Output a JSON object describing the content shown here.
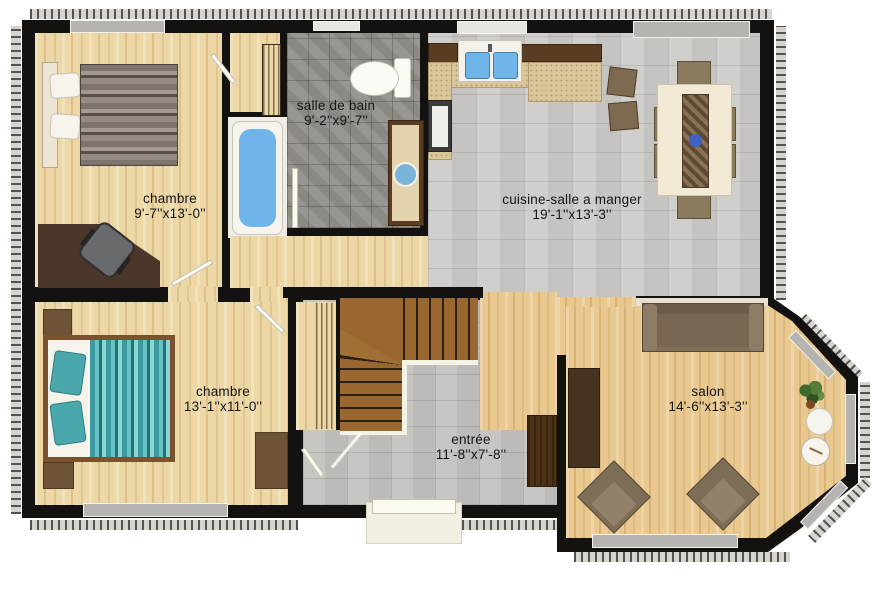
{
  "rooms": [
    {
      "name": "chambre",
      "dims": "9'-7''x13'-0''"
    },
    {
      "name": "salle de bain",
      "dims": "9'-2''x9'-7''"
    },
    {
      "name": "cuisine-salle a manger",
      "dims": "19'-1''x13'-3''"
    },
    {
      "name": "chambre",
      "dims": "13'-1''x11'-0''"
    },
    {
      "name": "entrée",
      "dims": "11'-8''x7'-8''"
    },
    {
      "name": "salon",
      "dims": "14'-6''x13'-3''"
    }
  ],
  "colors": {
    "wall": "#141210",
    "wood_bedroom": "#ecd7a5",
    "wood_salon": "#e9c98f",
    "tile_bath": "#93908c",
    "tile_kitchen": "#cbcac6",
    "tile_entry": "#c2c1bd",
    "tub_blue": "#6fb5ea",
    "sink_blue": "#7ab4d8",
    "bed_teal": "#4aa7ac",
    "bed_gray": "#8a8178",
    "counter_beige": "#d9c69a",
    "cabinet_brown": "#5a3c22",
    "stair_brown": "#9a6730",
    "sofa_brown": "#7e6e57",
    "label_text": "#141414"
  }
}
